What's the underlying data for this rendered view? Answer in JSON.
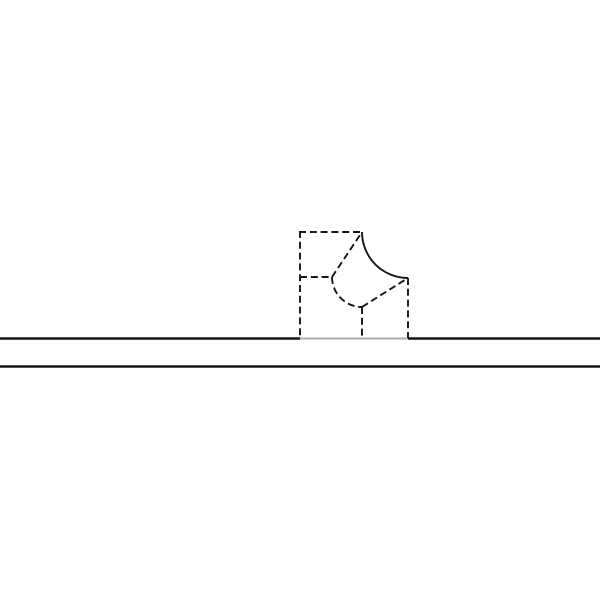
{
  "canvas": {
    "width": 600,
    "height": 600,
    "background": "#ffffff"
  },
  "colors": {
    "black": "#161616",
    "gray": "#a9a9a9",
    "background": "#ffffff"
  },
  "stroke": {
    "dash_pattern": "7 3.8",
    "hidden_line_width": 1.9,
    "ground_line_width": 2.6,
    "gray_line_width": 2.1
  },
  "figure": {
    "segments": [
      {
        "name": "ground-line-upper-left",
        "type": "line",
        "x1": 0,
        "y1": 338.5,
        "x2": 300,
        "y2": 338.5,
        "stroke": "black",
        "width": 2.6,
        "dashed": false
      },
      {
        "name": "ground-line-upper-hidden",
        "type": "line",
        "x1": 300,
        "y1": 338.5,
        "x2": 408,
        "y2": 338.5,
        "stroke": "gray",
        "width": 2.1,
        "dashed": false
      },
      {
        "name": "ground-line-upper-right",
        "type": "line",
        "x1": 408,
        "y1": 338.5,
        "x2": 600,
        "y2": 338.5,
        "stroke": "black",
        "width": 2.6,
        "dashed": false
      },
      {
        "name": "ground-line-lower",
        "type": "line",
        "x1": 0,
        "y1": 366.5,
        "x2": 600,
        "y2": 366.5,
        "stroke": "black",
        "width": 2.6,
        "dashed": false
      },
      {
        "name": "block-left-edge",
        "type": "line",
        "x1": 300,
        "y1": 231,
        "x2": 300,
        "y2": 338,
        "stroke": "black",
        "width": 1.9,
        "dashed": true
      },
      {
        "name": "block-top-edge",
        "type": "line",
        "x1": 299,
        "y1": 232,
        "x2": 362,
        "y2": 232,
        "stroke": "black",
        "width": 1.9,
        "dashed": true
      },
      {
        "name": "notch-outer-arc",
        "type": "arc",
        "x1": 362,
        "y1": 232,
        "rx": 46,
        "ry": 46,
        "sweep": 0,
        "x2": 408,
        "y2": 278,
        "stroke": "black",
        "width": 1.9,
        "dashed": false
      },
      {
        "name": "block-right-edge",
        "type": "line",
        "x1": 408,
        "y1": 278,
        "x2": 408,
        "y2": 338,
        "stroke": "black",
        "width": 1.9,
        "dashed": true
      },
      {
        "name": "inner-horizontal-edge",
        "type": "line",
        "x1": 300,
        "y1": 277,
        "x2": 332,
        "y2": 277,
        "stroke": "black",
        "width": 1.9,
        "dashed": true
      },
      {
        "name": "inner-diagonal-to-top",
        "type": "line",
        "x1": 332,
        "y1": 277,
        "x2": 362,
        "y2": 232,
        "stroke": "black",
        "width": 1.9,
        "dashed": true
      },
      {
        "name": "inner-notch-arc",
        "type": "arc",
        "x1": 332,
        "y1": 277,
        "rx": 30,
        "ry": 30,
        "sweep": 0,
        "x2": 362,
        "y2": 307,
        "stroke": "black",
        "width": 1.9,
        "dashed": true
      },
      {
        "name": "inner-diagonal-to-right",
        "type": "line",
        "x1": 362,
        "y1": 307,
        "x2": 408,
        "y2": 278,
        "stroke": "black",
        "width": 1.9,
        "dashed": true
      },
      {
        "name": "inner-vertical-edge",
        "type": "line",
        "x1": 362,
        "y1": 307,
        "x2": 362,
        "y2": 338,
        "stroke": "black",
        "width": 1.9,
        "dashed": true
      }
    ]
  }
}
